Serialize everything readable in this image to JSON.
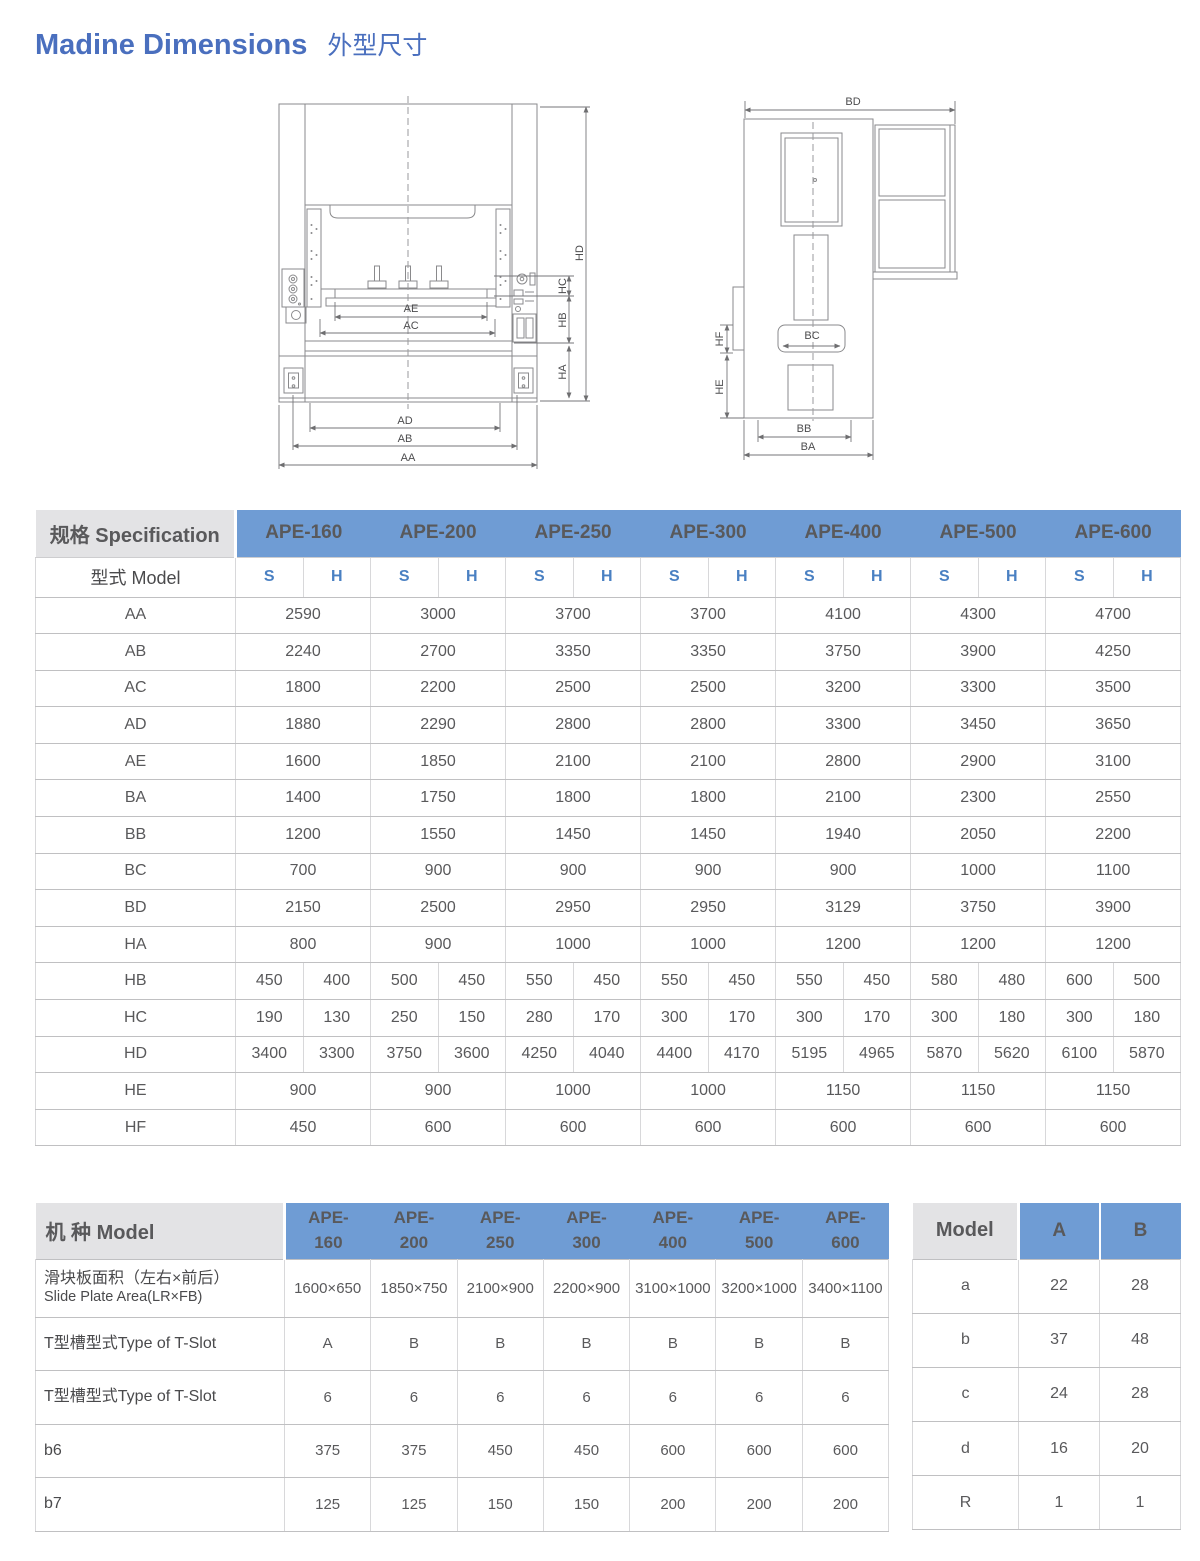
{
  "page": {
    "title_en": "Madine Dimensions",
    "title_zh": "外型尺寸"
  },
  "colors": {
    "accent_blue": "#6f9cd4",
    "title_blue": "#4a6fbe",
    "header_gray": "#e3e3e5",
    "sh_blue": "#4a80c2"
  },
  "front_view": {
    "labels": {
      "aa": "AA",
      "ab": "AB",
      "ac": "AC",
      "ad": "AD",
      "ae": "AE",
      "ha": "HA",
      "hb": "HB",
      "hc": "HC",
      "hd": "HD"
    }
  },
  "side_view": {
    "labels": {
      "ba": "BA",
      "bb": "BB",
      "bc": "BC",
      "bd": "BD",
      "he": "HE",
      "hf": "HF"
    }
  },
  "spec_table": {
    "header_label": "规格 Specification",
    "model_row_label": "型式 Model",
    "models": [
      "APE-160",
      "APE-200",
      "APE-250",
      "APE-300",
      "APE-400",
      "APE-500",
      "APE-600"
    ],
    "sub_cols": [
      "S",
      "H"
    ],
    "rows": [
      {
        "label": "AA",
        "span": true,
        "values": [
          "2590",
          "3000",
          "3700",
          "3700",
          "4100",
          "4300",
          "4700"
        ]
      },
      {
        "label": "AB",
        "span": true,
        "values": [
          "2240",
          "2700",
          "3350",
          "3350",
          "3750",
          "3900",
          "4250"
        ]
      },
      {
        "label": "AC",
        "span": true,
        "values": [
          "1800",
          "2200",
          "2500",
          "2500",
          "3200",
          "3300",
          "3500"
        ]
      },
      {
        "label": "AD",
        "span": true,
        "values": [
          "1880",
          "2290",
          "2800",
          "2800",
          "3300",
          "3450",
          "3650"
        ]
      },
      {
        "label": "AE",
        "span": true,
        "values": [
          "1600",
          "1850",
          "2100",
          "2100",
          "2800",
          "2900",
          "3100"
        ]
      },
      {
        "label": "BA",
        "span": true,
        "values": [
          "1400",
          "1750",
          "1800",
          "1800",
          "2100",
          "2300",
          "2550"
        ]
      },
      {
        "label": "BB",
        "span": true,
        "values": [
          "1200",
          "1550",
          "1450",
          "1450",
          "1940",
          "2050",
          "2200"
        ]
      },
      {
        "label": "BC",
        "span": true,
        "values": [
          "700",
          "900",
          "900",
          "900",
          "900",
          "1000",
          "1100"
        ]
      },
      {
        "label": "BD",
        "span": true,
        "values": [
          "2150",
          "2500",
          "2950",
          "2950",
          "3129",
          "3750",
          "3900"
        ]
      },
      {
        "label": "HA",
        "span": true,
        "values": [
          "800",
          "900",
          "1000",
          "1000",
          "1200",
          "1200",
          "1200"
        ]
      },
      {
        "label": "HB",
        "span": false,
        "values": [
          "450",
          "400",
          "500",
          "450",
          "550",
          "450",
          "550",
          "450",
          "550",
          "450",
          "580",
          "480",
          "600",
          "500"
        ]
      },
      {
        "label": "HC",
        "span": false,
        "values": [
          "190",
          "130",
          "250",
          "150",
          "280",
          "170",
          "300",
          "170",
          "300",
          "170",
          "300",
          "180",
          "300",
          "180"
        ]
      },
      {
        "label": "HD",
        "span": false,
        "values": [
          "3400",
          "3300",
          "3750",
          "3600",
          "4250",
          "4040",
          "4400",
          "4170",
          "5195",
          "4965",
          "5870",
          "5620",
          "6100",
          "5870"
        ]
      },
      {
        "label": "HE",
        "span": true,
        "values": [
          "900",
          "900",
          "1000",
          "1000",
          "1150",
          "1150",
          "1150"
        ]
      },
      {
        "label": "HF",
        "span": true,
        "values": [
          "450",
          "600",
          "600",
          "600",
          "600",
          "600",
          "600"
        ]
      }
    ]
  },
  "model_table": {
    "header_label": "机 种 Model",
    "models_line1": [
      "APE-",
      "APE-",
      "APE-",
      "APE-",
      "APE-",
      "APE-",
      "APE-"
    ],
    "models_line2": [
      "160",
      "200",
      "250",
      "300",
      "400",
      "500",
      "600"
    ],
    "rows": [
      {
        "label_zh": "滑块板面积（左右×前后）",
        "label_en": "Slide Plate Area(LR×FB)",
        "values": [
          "1600×650",
          "1850×750",
          "2100×900",
          "2200×900",
          "3100×1000",
          "3200×1000",
          "3400×1100"
        ]
      },
      {
        "label_zh": "T型槽型式Type of T-Slot",
        "values": [
          "A",
          "B",
          "B",
          "B",
          "B",
          "B",
          "B"
        ]
      },
      {
        "label_zh": "T型槽型式Type of T-Slot",
        "values": [
          "6",
          "6",
          "6",
          "6",
          "6",
          "6",
          "6"
        ]
      },
      {
        "label_zh": "b6",
        "values": [
          "375",
          "375",
          "450",
          "450",
          "600",
          "600",
          "600"
        ]
      },
      {
        "label_zh": "b7",
        "values": [
          "125",
          "125",
          "150",
          "150",
          "200",
          "200",
          "200"
        ]
      }
    ]
  },
  "tslot_table": {
    "header_label": "Model",
    "columns": [
      "A",
      "B"
    ],
    "rows": [
      {
        "label": "a",
        "values": [
          "22",
          "28"
        ]
      },
      {
        "label": "b",
        "values": [
          "37",
          "48"
        ]
      },
      {
        "label": "c",
        "values": [
          "24",
          "28"
        ]
      },
      {
        "label": "d",
        "values": [
          "16",
          "20"
        ]
      },
      {
        "label": "R",
        "values": [
          "1",
          "1"
        ]
      }
    ]
  }
}
